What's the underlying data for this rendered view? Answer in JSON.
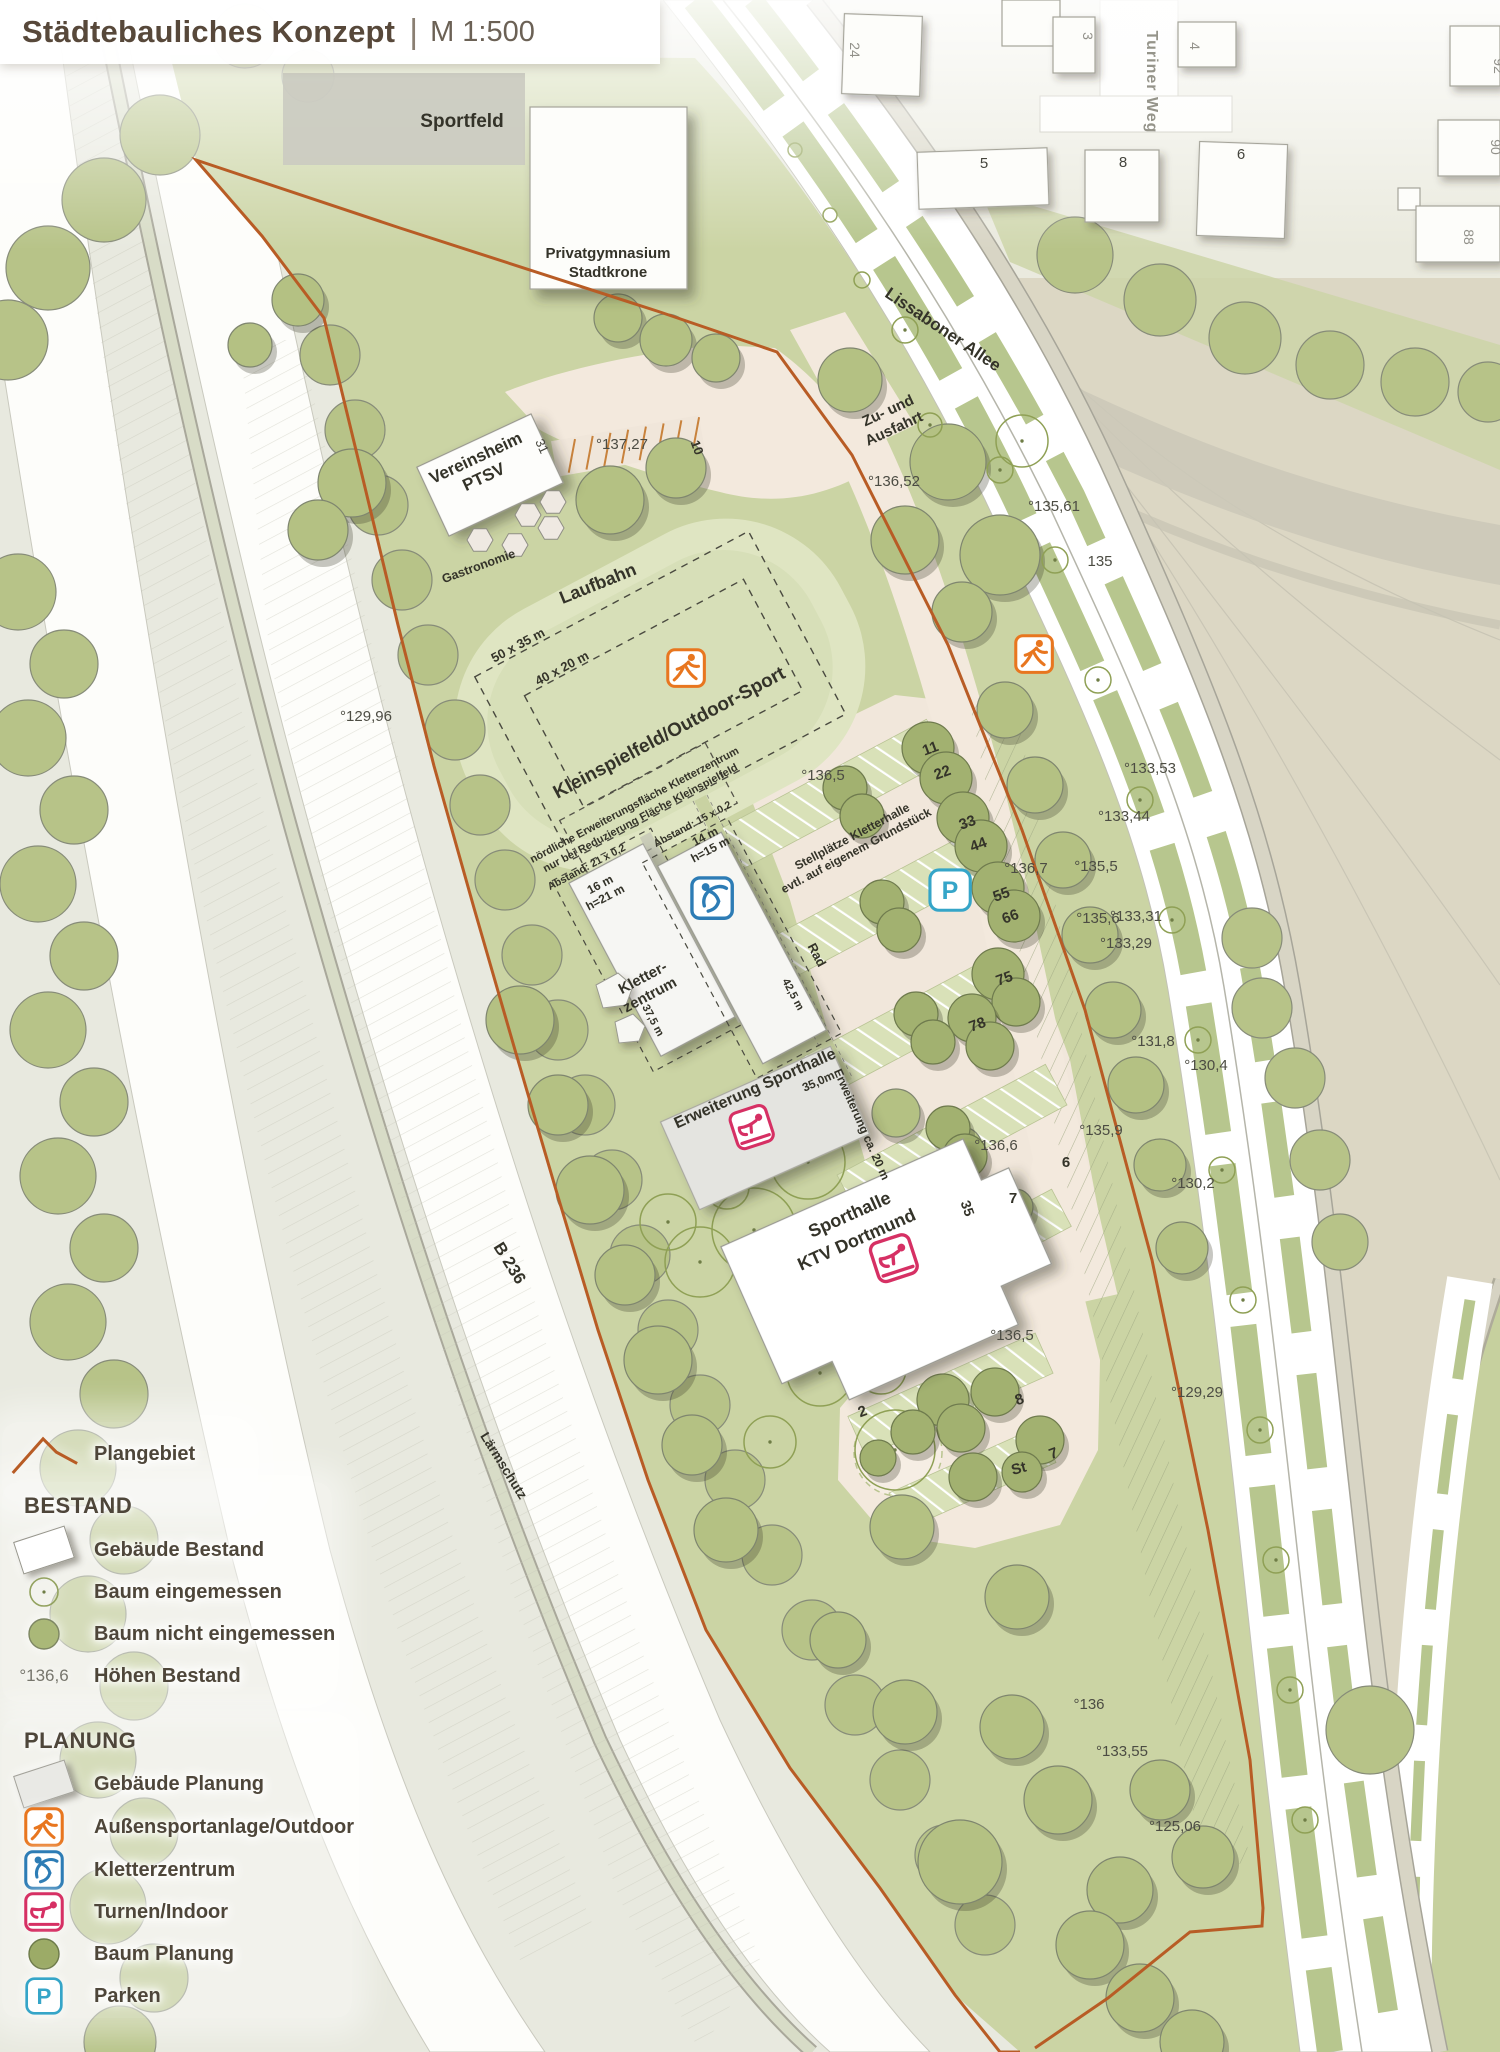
{
  "title": {
    "main": "Städtebauliches Konzept",
    "separator": "|",
    "scale": "M 1:500"
  },
  "legend": {
    "plangebiet": "Plangebiet",
    "bestand_heading": "BESTAND",
    "planung_heading": "PLANUNG",
    "items": {
      "b_gebaeude": "Gebäude Bestand",
      "b_baum_ein": "Baum eingemessen",
      "b_baum_nicht": "Baum nicht eingemessen",
      "b_hoehen": "Höhen Bestand",
      "b_hoehen_icon": "°136,6",
      "p_gebaeude": "Gebäude Planung",
      "p_aussen": "Außensportanlage/Outdoor",
      "p_kletter": "Kletterzentrum",
      "p_turnen": "Turnen/Indoor",
      "p_baum": "Baum Planung",
      "p_parken": "Parken",
      "p_parken_icon": "P"
    }
  },
  "map": {
    "streets": {
      "lissaboner": "Lissaboner Allee",
      "turiner": "Turiner Weg",
      "b236": "B 236",
      "laermschutz": "Lärmschutz",
      "zufahrt1": "Zu- und",
      "zufahrt2": "Ausfahrt",
      "rad": "Rad"
    },
    "areas": {
      "sportfeld": "Sportfeld",
      "laufbahn": "Laufbahn",
      "kleinspielfeld": "Kleinspielfeld/Outdoor-Sport",
      "gastronomie": "Gastronomie"
    },
    "buildings": {
      "gym1": "Privatgymnasium",
      "gym2": "Stadtkrone",
      "ver1": "Vereinsheim",
      "ver2": "PTSV",
      "kl1": "Kletter-",
      "kl2": "zentrum",
      "erw": "Erweiterung Sporthalle",
      "sp1": "Sporthalle",
      "sp2": "KTV Dortmund"
    },
    "notes": {
      "no1": "nördliche Erweiterungsfläche Kletterzentrum",
      "no2": "nur bei Reduzierung Fläche Kleinspielfeld",
      "st1": "Stellplätze Kletterhalle",
      "st2": "evtl. auf eigenem Grundstück",
      "ab21": "Abstand: 21 x 0,2",
      "ab15": "Abstand: 15 x 0,2"
    },
    "dims": {
      "f50": "50 x 35 m",
      "f40": "40 x 20 m",
      "b16": "16 m",
      "b16h": "h=21 m",
      "b14": "14 m",
      "b14h": "h=15 m",
      "d375": "37,5 m",
      "d425": "42,5 m",
      "d350": "35,0m",
      "erw20": "Erweiterung ca. 20 m"
    },
    "elev": {
      "e13727": "°137,27",
      "e13652": "°136,52",
      "e13561": "°135,61",
      "e135": "135",
      "e12996": "°129,96",
      "e1365a": "°136,5",
      "e13353": "°133,53",
      "e13344": "°133,44",
      "e1355": "°135,5",
      "e1367": "°136,7",
      "e1356": "°135,6",
      "e13331": "°133,31",
      "e13329": "°133,29",
      "e1318": "°131,8",
      "e1304": "°130,4",
      "e1359": "°135,9",
      "e1366": "°136,6",
      "e1302": "°130,2",
      "e1365b": "°136,5",
      "e12929": "°129,29",
      "e136": "°136",
      "e13355": "°133,55",
      "e12506": "°125,06"
    },
    "park": {
      "p10": "10",
      "p11": "11",
      "p22": "22",
      "p33": "33",
      "p44": "44",
      "p55": "55",
      "p66": "66",
      "p75": "75",
      "p78": "78",
      "p6": "6",
      "p7a": "7",
      "p35": "35",
      "p2": "2",
      "p8": "8",
      "pSt": "St",
      "p7b": "7"
    },
    "house": {
      "n24": "24",
      "n3": "3",
      "n4": "4",
      "n5": "5",
      "n8": "8",
      "n6": "6",
      "n92": "92",
      "n90": "90",
      "n88": "88",
      "n31": "31"
    }
  },
  "colors": {
    "boundary": "#b85c25",
    "outdoor_icon": "#e8761f",
    "climb_icon": "#2d7cb5",
    "turnen_icon": "#d63064",
    "parken_icon": "#35a5c8",
    "tree_bestand": "#b7c388",
    "tree_planung": "#a2b170",
    "site_green": "#cbd4a4"
  }
}
